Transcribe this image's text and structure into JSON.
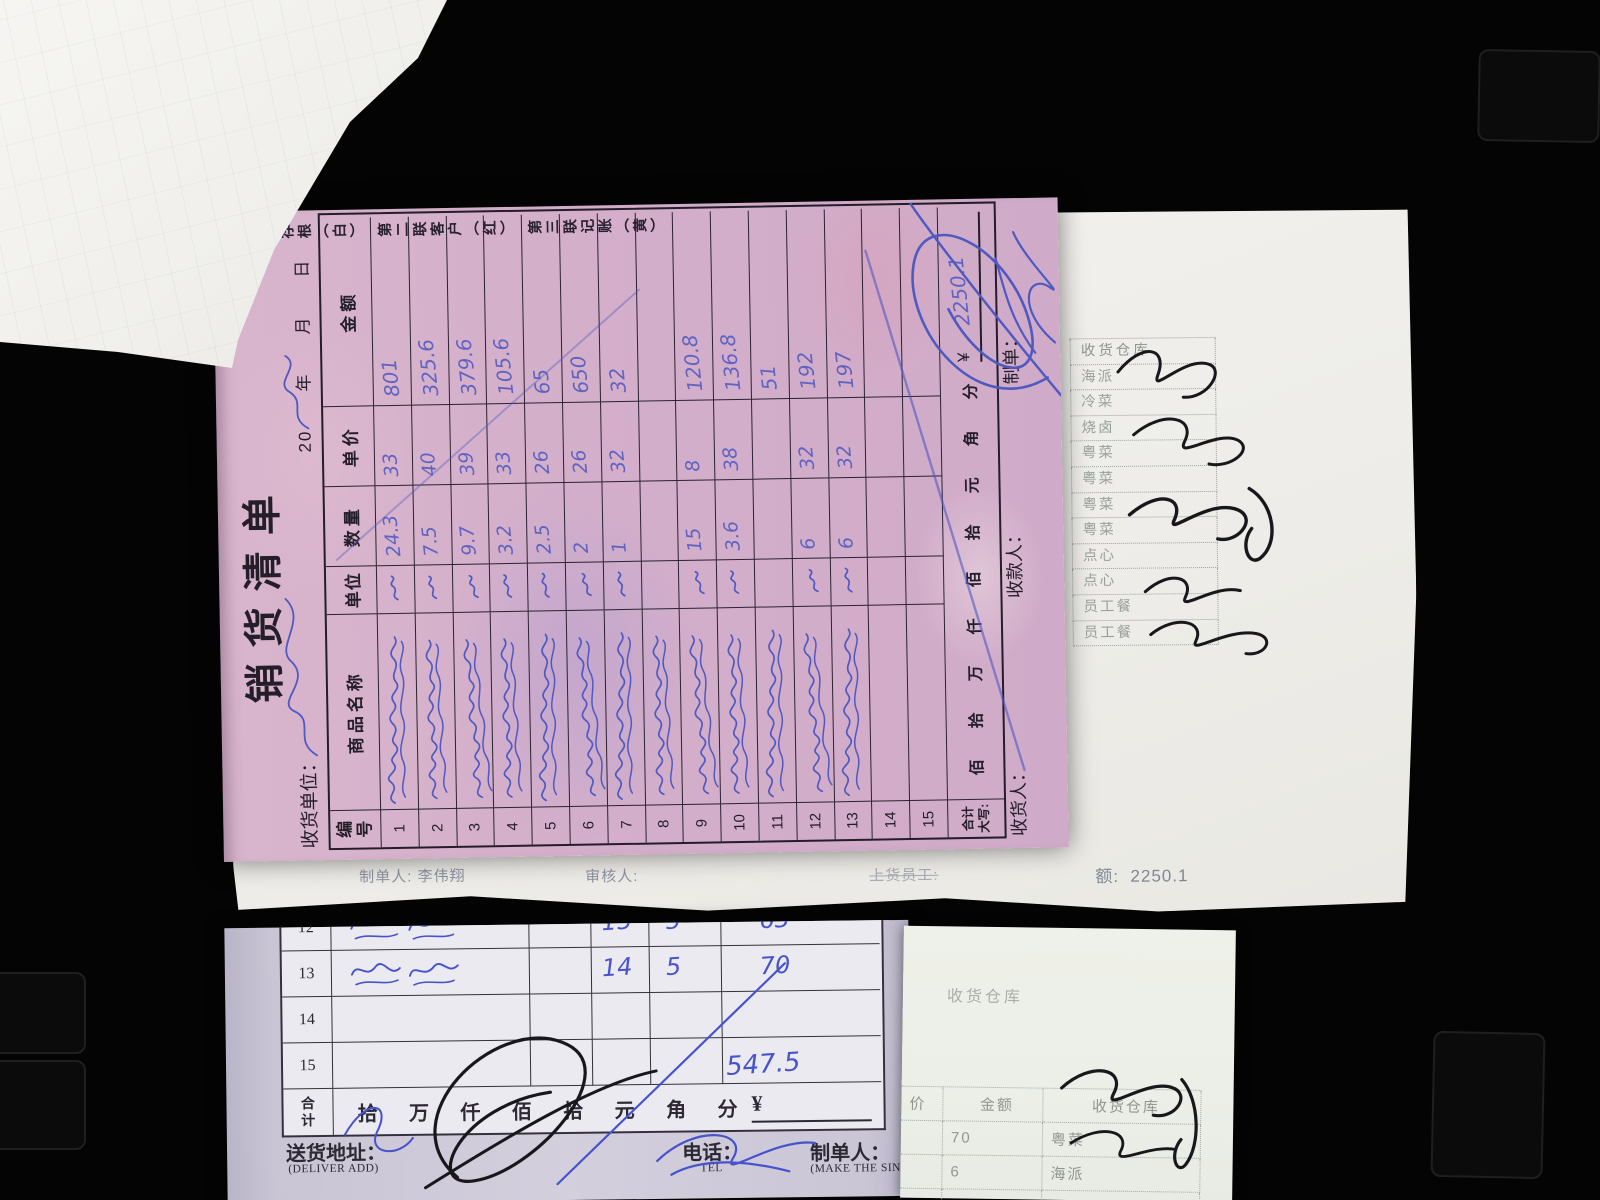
{
  "colors": {
    "paper_pink": "#d6b2ca",
    "ink_blue": "#5059c0",
    "ink_blue2": "#4753cc",
    "ink_black": "#17171c",
    "print_dark": "#241e2a",
    "faded_print": "#8d93a0"
  },
  "pink_receipt": {
    "copy_notice": "第一联存根（白）　第二联客户（红）　第三联记账（黄）",
    "title": "销货清单",
    "receiver_label": "收货单位：",
    "date_line": "20　　年　　月　　日",
    "table": {
      "headers": [
        "编号",
        "商品名称",
        "单位",
        "数量",
        "单价",
        "金额"
      ],
      "rows": [
        {
          "no": "1",
          "qty": "24.3",
          "price": "33",
          "amount": "801",
          "name_ink": true,
          "unit_ink": true
        },
        {
          "no": "2",
          "qty": "7.5",
          "price": "40",
          "amount": "325.6",
          "name_ink": true,
          "unit_ink": true
        },
        {
          "no": "3",
          "qty": "9.7",
          "price": "39",
          "amount": "379.6",
          "name_ink": true,
          "unit_ink": true
        },
        {
          "no": "4",
          "qty": "3.2",
          "price": "33",
          "amount": "105.6",
          "name_ink": true,
          "unit_ink": true
        },
        {
          "no": "5",
          "qty": "2.5",
          "price": "26",
          "amount": "65",
          "name_ink": true,
          "unit_ink": true
        },
        {
          "no": "6",
          "qty": "2",
          "price": "26",
          "amount": "650",
          "name_ink": true,
          "unit_ink": true
        },
        {
          "no": "7",
          "qty": "1",
          "price": "32",
          "amount": "32",
          "name_ink": true,
          "unit_ink": true
        },
        {
          "no": "8",
          "qty": "",
          "price": "",
          "amount": "",
          "name_ink": true,
          "unit_ink": false
        },
        {
          "no": "9",
          "qty": "15",
          "price": "8",
          "amount": "120.8",
          "name_ink": true,
          "unit_ink": true
        },
        {
          "no": "10",
          "qty": "3.6",
          "price": "38",
          "amount": "136.8",
          "name_ink": true,
          "unit_ink": true
        },
        {
          "no": "11",
          "qty": "",
          "price": "",
          "amount": "51",
          "name_ink": true,
          "unit_ink": false
        },
        {
          "no": "12",
          "qty": "6",
          "price": "32",
          "amount": "192",
          "name_ink": true,
          "unit_ink": true
        },
        {
          "no": "13",
          "qty": "6",
          "price": "32",
          "amount": "197",
          "name_ink": true,
          "unit_ink": true
        },
        {
          "no": "14",
          "qty": "",
          "price": "",
          "amount": "",
          "name_ink": false,
          "unit_ink": false
        },
        {
          "no": "15",
          "qty": "",
          "price": "",
          "amount": "",
          "name_ink": false,
          "unit_ink": false
        }
      ],
      "total_label": "合计",
      "daxie_label": "大写:",
      "amount_units": [
        "佰",
        "拾",
        "万",
        "仟",
        "佰",
        "拾",
        "元",
        "角",
        "分"
      ],
      "currency": "¥",
      "total_handwritten": "2250.1"
    },
    "footer": {
      "receiver": "收货人：",
      "payee": "收款人：",
      "maker": "制单："
    }
  },
  "under_sheet": {
    "maker_label": "制单人:",
    "maker_value": "李伟翔",
    "auditor_label": "审核人:",
    "loader_label": "上货员工:",
    "amount_label": "额:",
    "amount_value": "2250.1"
  },
  "warehouse_slip": {
    "header": "收货仓库",
    "items": [
      {
        "label": "海派"
      },
      {
        "label": "冷菜"
      },
      {
        "label": "烧卤"
      },
      {
        "label": "粤菜"
      },
      {
        "label": "粤菜"
      },
      {
        "label": "粤菜"
      },
      {
        "label": "粤菜"
      },
      {
        "label": "点心"
      },
      {
        "label": "点心"
      },
      {
        "label": "员工餐"
      },
      {
        "label": "员工餐"
      }
    ]
  },
  "bottom_receipt": {
    "rows": [
      {
        "no": "12",
        "name": "",
        "qty": "15",
        "price": "5",
        "amount": "63",
        "name_ink": true
      },
      {
        "no": "13",
        "name": "茄苦",
        "qty": "14",
        "price": "5",
        "amount": "70",
        "name_ink": true
      },
      {
        "no": "14",
        "name": "",
        "qty": "",
        "price": "",
        "amount": "",
        "name_ink": false
      },
      {
        "no": "15",
        "name": "",
        "qty": "",
        "price": "",
        "amount": "",
        "name_ink": false
      }
    ],
    "total_label": "合计",
    "amount_units": [
      "拾",
      "万",
      "仟",
      "佰",
      "拾",
      "元",
      "角",
      "分"
    ],
    "currency": "¥",
    "handwritten_total": "547.5",
    "footer": {
      "address_label": "送货地址：",
      "address_sub": "(DELIVER ADD)",
      "tel_label": "电话：",
      "tel_sub": "TEL",
      "maker_label": "制单人：",
      "maker_sub": "(MAKE THE SINGLE)"
    }
  },
  "bottom_right_slip": {
    "warehouse_ghost": "收货仓库",
    "headers": [
      "价",
      "金额",
      "收货仓库"
    ],
    "rows": [
      {
        "amount": "70",
        "warehouse": "粤菜"
      },
      {
        "amount": "6",
        "warehouse": "海派"
      },
      {
        "amount": "40",
        "warehouse": "海派"
      }
    ]
  }
}
